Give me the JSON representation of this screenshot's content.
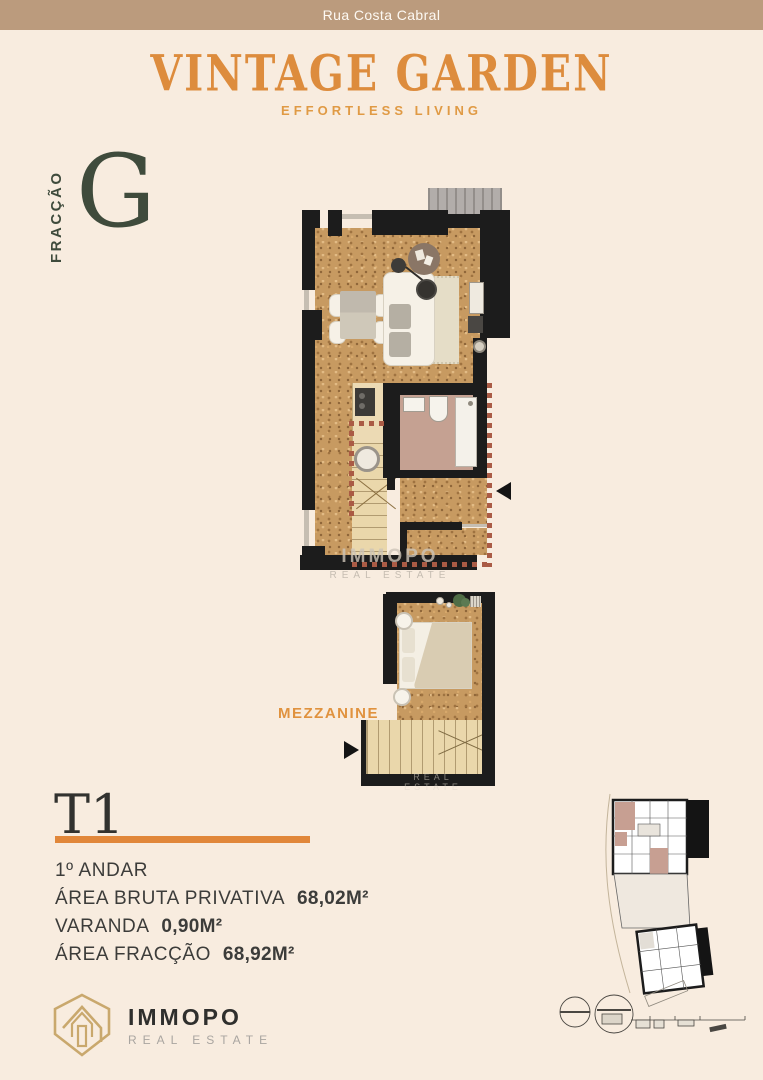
{
  "topbar": {
    "street": "Rua Costa Cabral"
  },
  "header": {
    "title": "VINTAGE GARDEN",
    "subtitle": "EFFORTLESS LIVING"
  },
  "fraction": {
    "label": "FRACÇÃO",
    "letter": "G"
  },
  "floorplan": {
    "mezzanine_label": "MEZZANINE",
    "watermark_brand": "IMMOPO",
    "watermark_sub": "REAL ESTATE"
  },
  "details": {
    "typology": "T1",
    "floor": "1º ANDAR",
    "rows": [
      {
        "label": "ÁREA BRUTA PRIVATIVA",
        "value": "68,02M²"
      },
      {
        "label": "VARANDA",
        "value": "0,90M²"
      },
      {
        "label": "ÁREA FRACÇÃO",
        "value": "68,92M²"
      }
    ]
  },
  "footer": {
    "brand": "IMMOPO",
    "brand_sub": "REAL ESTATE"
  },
  "colors": {
    "accent_orange": "#e1873a",
    "title_orange": "#dd8c3d",
    "dark_green": "#3f4b3c",
    "topbar_tan": "#bb9b7d",
    "background_cream": "#f8ecdf",
    "wall_black": "#1c1c1c",
    "cork_floor": "#c79a61",
    "bathroom_floor": "#c5a192",
    "dashed_line": "#aa5b45",
    "logo_gold": "#c9a86d"
  }
}
